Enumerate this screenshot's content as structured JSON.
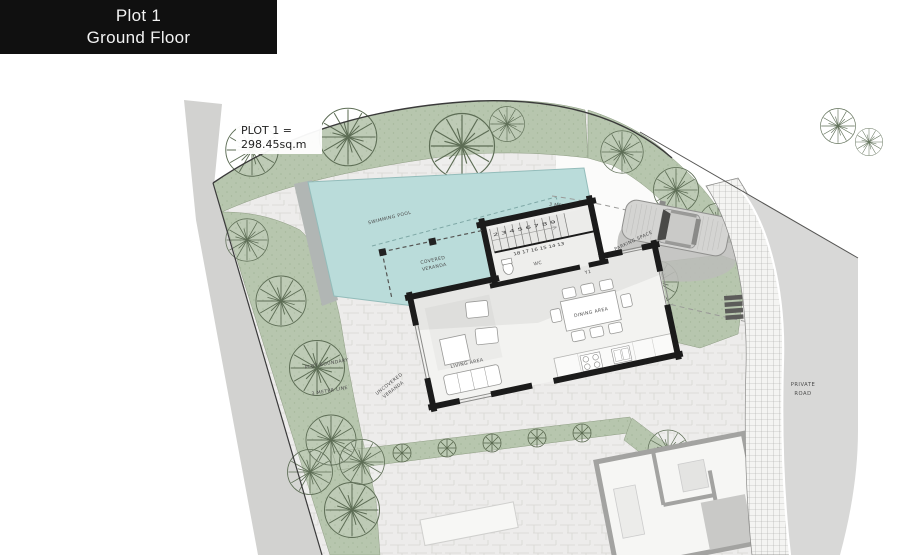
{
  "banner": {
    "line1": "Plot 1",
    "line2": "Ground Floor"
  },
  "plot_label": {
    "line1": "PLOT 1 =",
    "line2": "298.45sq.m"
  },
  "site_labels": {
    "swimming_pool": "SWIMMING POOL",
    "covered_veranda": [
      "COVERED",
      "VERANDA"
    ],
    "uncovered_veranda": [
      "UNCOVERED",
      "VERANDA"
    ],
    "parking_space": "PARKING SPACE",
    "meter_line_north": "3 METER LINE",
    "plot_boundary": "PLOT BOUNDARY",
    "meter_line_west": "3 METER LINE",
    "private_road": [
      "PRIVATE",
      "ROAD"
    ]
  },
  "house_labels": {
    "living": "LIVING AREA",
    "dining": "DINING AREA",
    "wc": "WC",
    "y1": "Y1",
    "stairs_top": "2 3 4 5 6 7 8 9",
    "stairs_bottom": "18 17 16 15 14 13"
  },
  "colors": {
    "banner_bg": "#101010",
    "banner_text": "#f2f2f2",
    "green": "#b7c6ae",
    "pool": "#badcda",
    "paving": "#edeceb",
    "road": "#d8d8d7",
    "house_wall": "#1b1b1b",
    "neighbor_wall": "#a3a3a1",
    "label_text": "#4c4c4c"
  }
}
